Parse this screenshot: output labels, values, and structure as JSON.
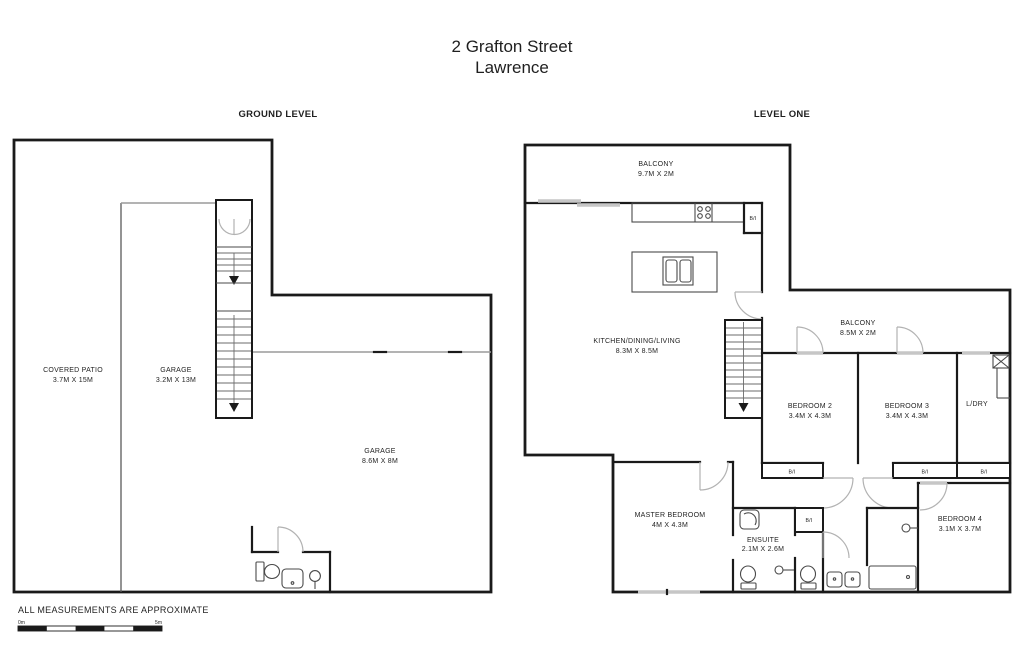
{
  "title": {
    "line1": "2 Grafton Street",
    "line2": "Lawrence"
  },
  "ground_level": {
    "heading": "GROUND LEVEL",
    "rooms": {
      "covered_patio": {
        "name": "COVERED PATIO",
        "dims": "3.7M X 15M"
      },
      "garage_long": {
        "name": "GARAGE",
        "dims": "3.2M X 13M"
      },
      "garage_main": {
        "name": "GARAGE",
        "dims": "8.6M X 8M"
      }
    }
  },
  "level_one": {
    "heading": "LEVEL ONE",
    "rooms": {
      "balcony_front": {
        "name": "BALCONY",
        "dims": "9.7M X 2M"
      },
      "kitchen_dining_living": {
        "name": "KITCHEN/DINING/LIVING",
        "dims": "8.3M X 8.5M"
      },
      "balcony_rear": {
        "name": "BALCONY",
        "dims": "8.5M X 2M"
      },
      "bedroom_2": {
        "name": "BEDROOM 2",
        "dims": "3.4M X 4.3M"
      },
      "bedroom_3": {
        "name": "BEDROOM 3",
        "dims": "3.4M X 4.3M"
      },
      "laundry": {
        "name": "L/DRY"
      },
      "master_bedroom": {
        "name": "MASTER BEDROOM",
        "dims": "4M X 4.3M"
      },
      "ensuite": {
        "name": "ENSUITE",
        "dims": "2.1M X 2.6M"
      },
      "bedroom_4": {
        "name": "BEDROOM 4",
        "dims": "3.1M X 3.7M"
      }
    },
    "built_in_label": "B/I"
  },
  "footer": {
    "disclaimer": "ALL MEASUREMENTS ARE APPROXIMATE",
    "scale_min": "0m",
    "scale_max": "5m"
  },
  "colors": {
    "wall": "#1a1a1a",
    "door": "#b2b2b2",
    "fixture": "#4a4a4a",
    "text": "#242424"
  }
}
